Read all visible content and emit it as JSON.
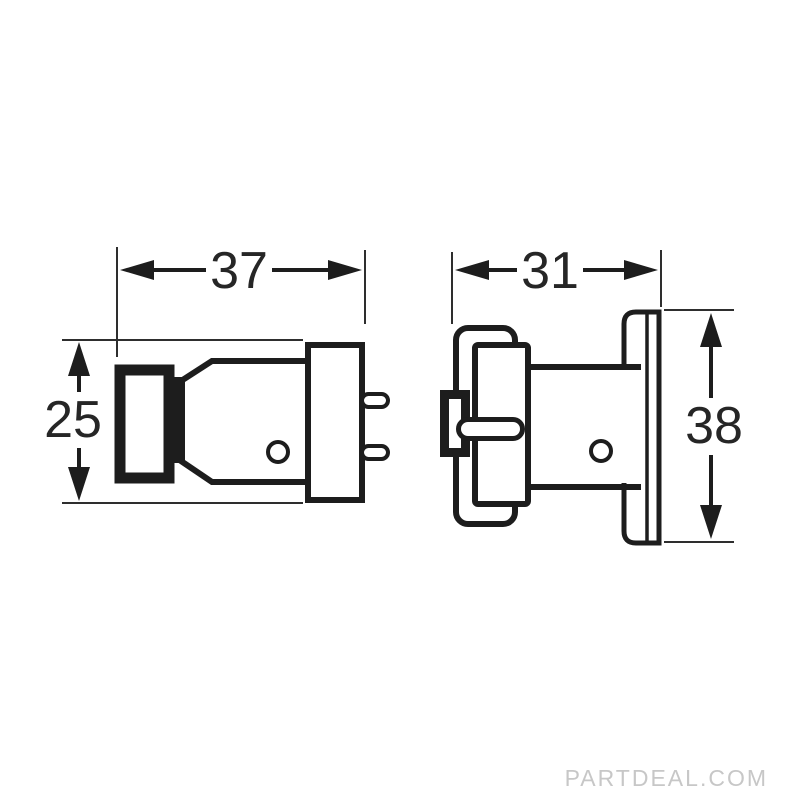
{
  "diagram": {
    "type": "technical-drawing",
    "dimensions": {
      "left_view_width": "37",
      "left_view_height": "25",
      "right_view_width": "31",
      "right_view_height": "38"
    }
  },
  "watermark": {
    "text": "PARTDEAL.COM"
  },
  "colors": {
    "line": "#1d1d1d",
    "dimension_text": "#262626",
    "watermark": "#c7c7c7",
    "background": "#ffffff"
  }
}
